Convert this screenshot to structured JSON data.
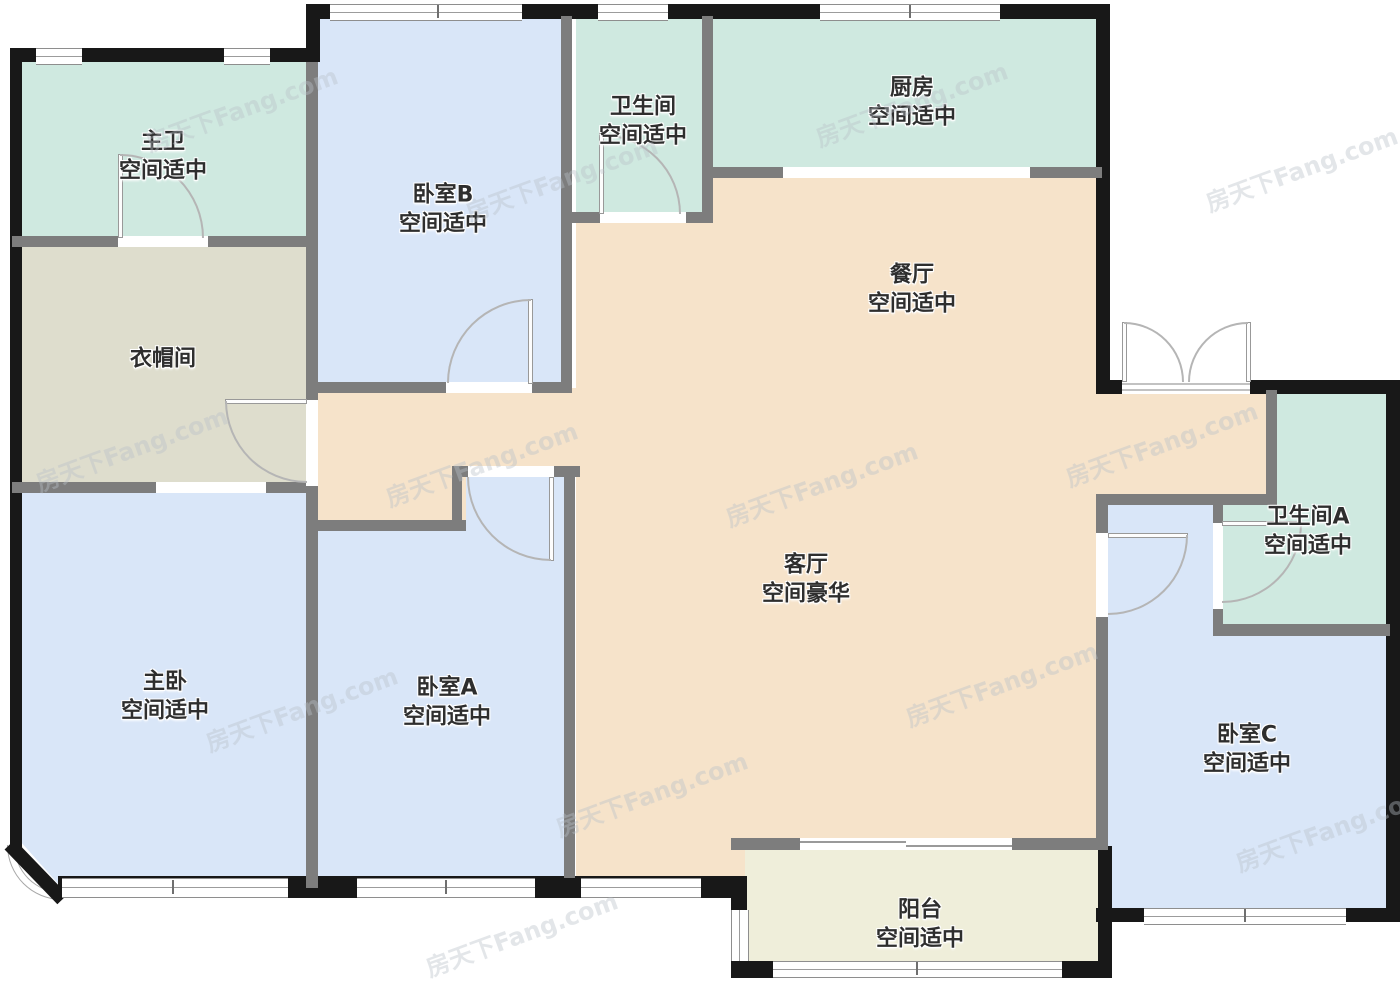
{
  "watermark": "房天下Fang.com",
  "colors": {
    "room_blue": "#d9e6f8",
    "room_mint": "#cfe9e0",
    "room_peach": "#f6e3ca",
    "room_beige": "#deddcd",
    "room_balcony": "#efeeda",
    "wall_black": "#181818",
    "wall_gray": "#7d7d7d"
  },
  "rooms": {
    "master_bath": {
      "name": "主卫",
      "assessment": "空间适中"
    },
    "cloakroom": {
      "name": "衣帽间",
      "assessment": ""
    },
    "master_bedroom": {
      "name": "主卧",
      "assessment": "空间适中"
    },
    "bedroom_b": {
      "name": "卧室B",
      "assessment": "空间适中"
    },
    "bedroom_a": {
      "name": "卧室A",
      "assessment": "空间适中"
    },
    "bathroom": {
      "name": "卫生间",
      "assessment": "空间适中"
    },
    "kitchen": {
      "name": "厨房",
      "assessment": "空间适中"
    },
    "dining_room": {
      "name": "餐厅",
      "assessment": "空间适中"
    },
    "living_room": {
      "name": "客厅",
      "assessment": "空间豪华"
    },
    "bathroom_a": {
      "name": "卫生间A",
      "assessment": "空间适中"
    },
    "bedroom_c": {
      "name": "卧室C",
      "assessment": "空间适中"
    },
    "balcony": {
      "name": "阳台",
      "assessment": "空间适中"
    }
  }
}
